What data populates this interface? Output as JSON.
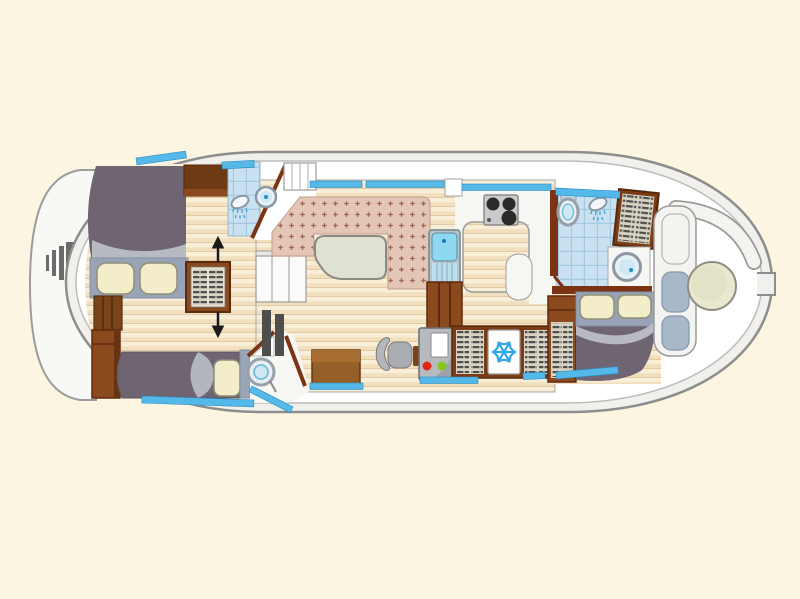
{
  "scene": {
    "kind": "houseboat-floor-plan",
    "view": "top-down deck plan, stern at left, bow at right",
    "visible_text": []
  },
  "colors": {
    "background": "#fbf5e2",
    "hull_outline": "#8d8d8d",
    "hull_band": "#f1f0ec",
    "deck": "#ffffff",
    "platform": "#f8f8f5",
    "ladder": "#6b6b6b",
    "window_blue": "#54b9e9",
    "wood_floor": "#f2dfbe",
    "wood_floor_stripe": "#f9efd9",
    "upholstery": "#e4c6b6",
    "upholstery_motif": "#9c6557",
    "table_top": "#dfe1d3",
    "bed_duvet": "#6f6472",
    "bed_band": "#98a3b5",
    "bed_fold": "#b7bac0",
    "pillow": "#f3edca",
    "wood_dark": "#6e3a14",
    "wood_frame": "#8a4a1e",
    "wood_wall": "#7a3414",
    "cabinet_panel": "#d8d3c2",
    "louver_slat": "#4f4f4f",
    "tile_blue": "#c9e1f1",
    "tile_grid": "#a7c9df",
    "fixture_ring": "#8b98a4",
    "fixture_water": "#cfe8f4",
    "shower_spray": "#4aa6d8",
    "stove_body": "#c9cbcd",
    "stove_burner": "#2b2b2b",
    "sink_basin": "#8fd8f2",
    "fridge_door": "#fdfdfc",
    "snowflake": "#2ea8e8",
    "panel_body": "#b7babe",
    "led_red": "#e02818",
    "led_green": "#84c818",
    "chair": "#b3b6ba",
    "desk": "#955f28",
    "stairs": "#fbfbf9",
    "hatch_dark": "#4e4e4e",
    "bow_cushion": "#a9b8c8",
    "bow_table": "#e9e7cf",
    "arrow": "#1a1a1a"
  },
  "sections": [
    {
      "name": "stern-swim-platform",
      "fixtures": [
        "swim-ladder"
      ]
    },
    {
      "name": "aft-cabin",
      "fixtures": [
        "double-bed",
        "pillow",
        "pillow",
        "bedside-cabinet",
        "tall-wardrobe",
        "louvered-cabinet-with-arrows",
        "single-bed",
        "pillow"
      ]
    },
    {
      "name": "aft-shower-room",
      "fixtures": [
        "shower-head",
        "washbasin",
        "storage-cabinet"
      ]
    },
    {
      "name": "aft-wc",
      "fixtures": [
        "toilet",
        "door"
      ]
    },
    {
      "name": "companionway",
      "fixtures": [
        "deck-steps",
        "interior-stairs",
        "hatch-panels"
      ]
    },
    {
      "name": "saloon",
      "fixtures": [
        "u-shaped-dinette-bench",
        "dinette-table"
      ]
    },
    {
      "name": "galley",
      "fixtures": [
        "three-burner-stove",
        "sink-unit",
        "worktop",
        "under-counter-cabinet"
      ]
    },
    {
      "name": "utility-corridor",
      "fixtures": [
        "chart-desk",
        "helm-chair",
        "electrical-panel",
        "refrigerator",
        "louvered-locker",
        "louvered-locker"
      ]
    },
    {
      "name": "forward-bathroom",
      "fixtures": [
        "toilet",
        "shower-head",
        "washbasin",
        "louvered-wardrobe"
      ]
    },
    {
      "name": "forward-cabin",
      "fixtures": [
        "double-bed",
        "pillow",
        "pillow",
        "louvered-wardrobe"
      ]
    },
    {
      "name": "bow-cockpit",
      "fixtures": [
        "bench-seat",
        "seat-cushion",
        "seat-cushion",
        "round-table"
      ]
    },
    {
      "name": "bow-tip",
      "fixtures": [
        "mooring-tab"
      ]
    },
    {
      "name": "windows",
      "fixtures": [
        "blue-window-strips-along-cabin-walls"
      ]
    }
  ]
}
